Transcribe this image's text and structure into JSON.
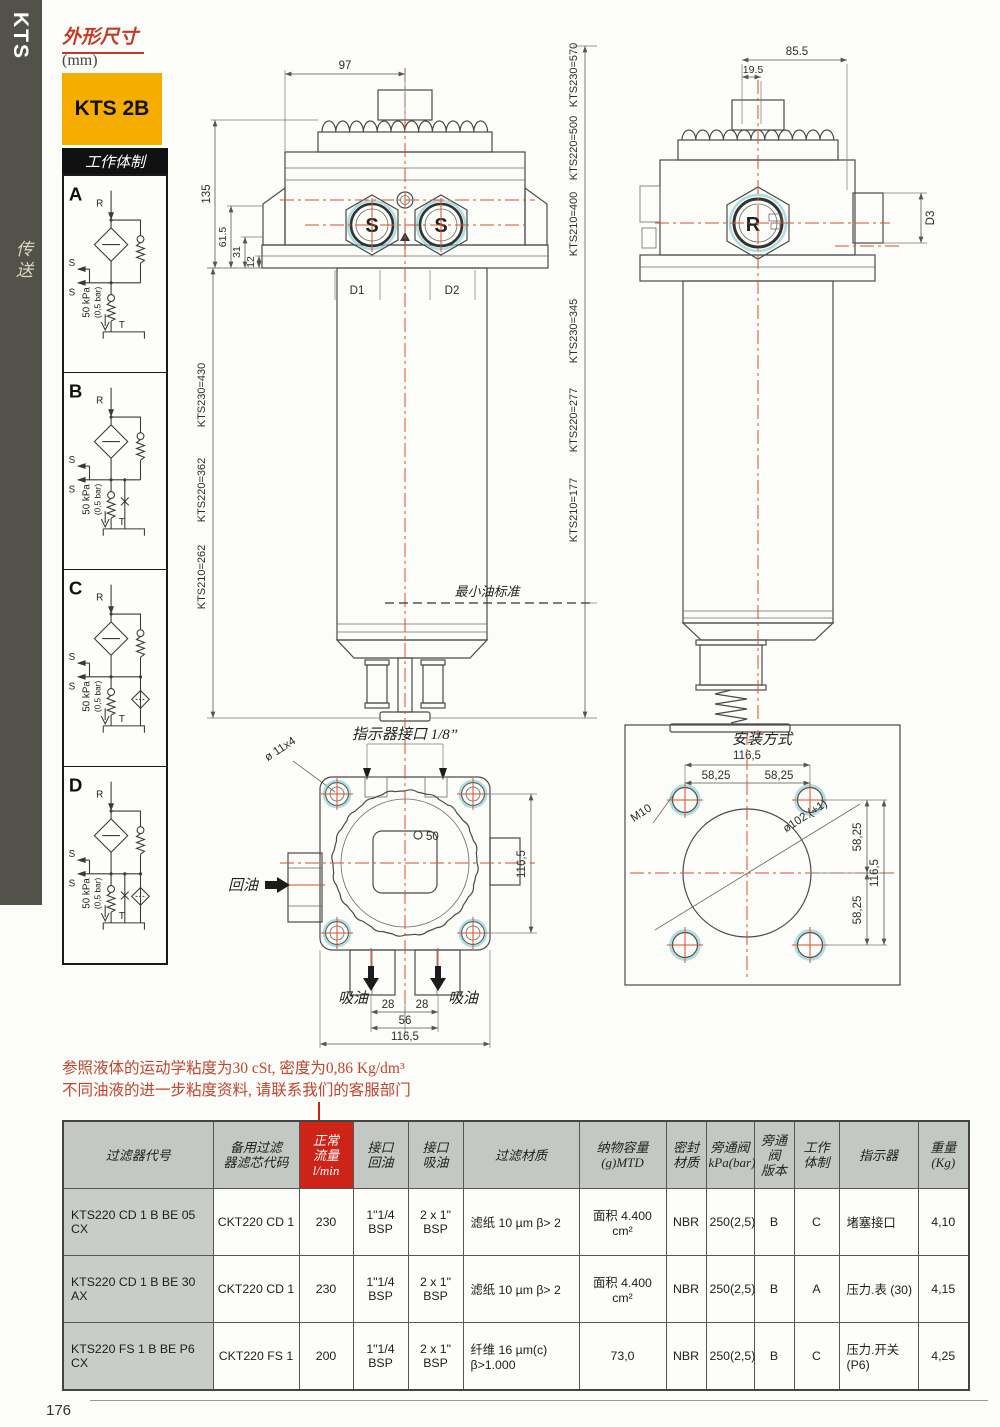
{
  "page": {
    "number": "176"
  },
  "sidebar": {
    "series": "KTS",
    "vertical_label": "传送"
  },
  "header": {
    "title": "外形尺寸",
    "unit": "(mm)",
    "badge": "KTS 2B"
  },
  "schemes": {
    "title": "工作体制",
    "labels": {
      "r": "R",
      "s": "S",
      "t": "T",
      "pressure": "50 kPa",
      "pressure_bar": "(0,5 bar)"
    },
    "variants": [
      {
        "id": "A",
        "extra_valve": false,
        "extra_filter": false
      },
      {
        "id": "B",
        "extra_valve": true,
        "extra_filter": false
      },
      {
        "id": "C",
        "extra_valve": false,
        "extra_filter": true
      },
      {
        "id": "D",
        "extra_valve": true,
        "extra_filter": true
      }
    ]
  },
  "drawing": {
    "front": {
      "dim_97": "97",
      "dim_135": "135",
      "dim_61_5": "61.5",
      "dim_31": "31",
      "dim_12": "12",
      "d1": "D1",
      "d2": "D2",
      "port": "S",
      "heights_total": [
        "KTS230=570",
        "KTS220=500",
        "KTS210=400"
      ],
      "heights_oil": [
        "KTS230=345",
        "KTS220=277",
        "KTS210=177"
      ],
      "heights_body": [
        "KTS230=430",
        "KTS220=362",
        "KTS210=262"
      ],
      "min_oil": "最小油标准"
    },
    "side": {
      "dim_85_5": "85.5",
      "dim_19_5": "19.5",
      "d3": "D3",
      "port": "R"
    },
    "top": {
      "indicator_port": "指示器接口 1/8”",
      "holes": "ø 11x4",
      "center_hole": "50",
      "return_port": "回油",
      "suction_port_left": "吸油",
      "suction_port_right": "吸油",
      "dim_28a": "28",
      "dim_28b": "28",
      "dim_56": "56",
      "dim_116_5": "116,5",
      "dim_116_5_side": "116,5"
    },
    "mounting": {
      "title": "安装方式",
      "dim_116_5_top": "116,5",
      "dim_58_left": "58,25",
      "dim_58_right": "58,25",
      "bolt": "M10",
      "bore": "ø102 (+1)",
      "dim_58_r1": "58,25",
      "dim_116_5_right": "116,5",
      "dim_58_r2": "58,25"
    }
  },
  "note": {
    "line1": "参照液体的运动学粘度为30 cSt, 密度为0,86 Kg/dm³",
    "line2": "不同油液的进一步粘度资料, 请联系我们的客服部门"
  },
  "table": {
    "headers": [
      "过滤器代号",
      "备用过滤\n器滤芯代码",
      "正常\n流量\nl/min",
      "接口\n回油",
      "接口\n吸油",
      "过滤材质",
      "纳物容量\n(g)MTD",
      "密封\n材质",
      "旁通阀\nkPa(bar)",
      "旁通阀\n版本",
      "工作\n体制",
      "指示器",
      "重量\n(Kg)"
    ],
    "rows": [
      [
        "KTS220 CD 1 B BE 05 CX",
        "CKT220 CD 1",
        "230",
        "1\"1/4 BSP",
        "2 x 1\" BSP",
        "滤纸 10 µm β> 2",
        "面积 4.400 cm²",
        "NBR",
        "250(2,5)",
        "B",
        "C",
        "堵塞接口",
        "4,10"
      ],
      [
        "KTS220 CD 1 B BE 30 AX",
        "CKT220 CD 1",
        "230",
        "1\"1/4 BSP",
        "2 x 1\" BSP",
        "滤纸 10 µm β> 2",
        "面积 4.400 cm²",
        "NBR",
        "250(2,5)",
        "B",
        "A",
        "压力.表 (30)",
        "4,15"
      ],
      [
        "KTS220 FS 1 B BE P6 CX",
        "CKT220 FS 1",
        "200",
        "1\"1/4 BSP",
        "2 x 1\" BSP",
        "纤维 16 µm(c) β>1.000",
        "73,0",
        "NBR",
        "250(2,5)",
        "B",
        "C",
        "压力.开关(P6)",
        "4,25"
      ]
    ]
  }
}
